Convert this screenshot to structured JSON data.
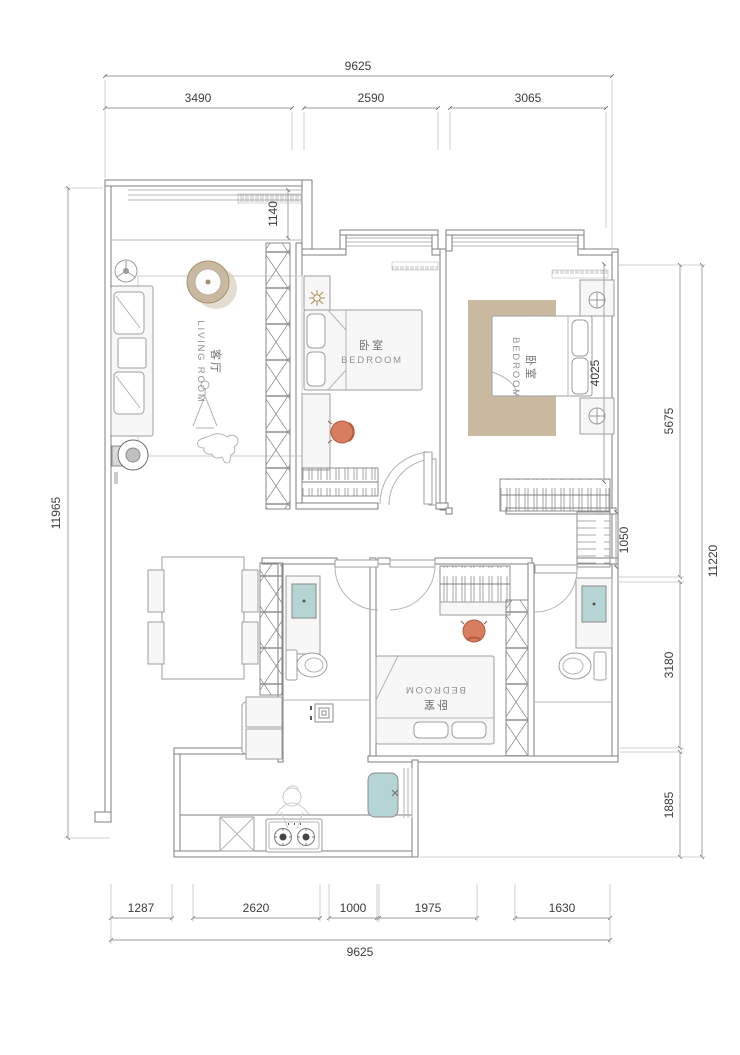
{
  "drawing_title": "apartment-floor-plan",
  "dimensions": {
    "top": {
      "total": "9625",
      "segments": [
        "3490",
        "2590",
        "3065"
      ]
    },
    "bottom": {
      "total": "9625",
      "segments": [
        "1287",
        "2620",
        "1000",
        "1975",
        "1630"
      ]
    },
    "left": {
      "total": "11965"
    },
    "right": {
      "total": "11220",
      "segments": [
        "5675",
        "3180",
        "1885"
      ]
    },
    "inner": {
      "balcony_depth": "1140",
      "bedroom2_width": "4025",
      "hall_cabinet_depth": "1050"
    }
  },
  "rooms": {
    "living_room": {
      "label_zh": "客厅",
      "label_en": "LIVING ROOM"
    },
    "bedroom_top_middle": {
      "label_zh": "卧室",
      "label_en": "BEDROOM"
    },
    "bedroom_top_right": {
      "label_zh": "卧室",
      "label_en": "BEDROOM"
    },
    "bedroom_bottom": {
      "label_zh": "卧室",
      "label_en": "BEDROOM"
    }
  },
  "legend_colors": {
    "wood_tan": "#c9b9a0",
    "fixture_teal": "#b5d5d5",
    "chair_orange": "#d87d5f",
    "wall_gray": "#7f7f7f"
  }
}
